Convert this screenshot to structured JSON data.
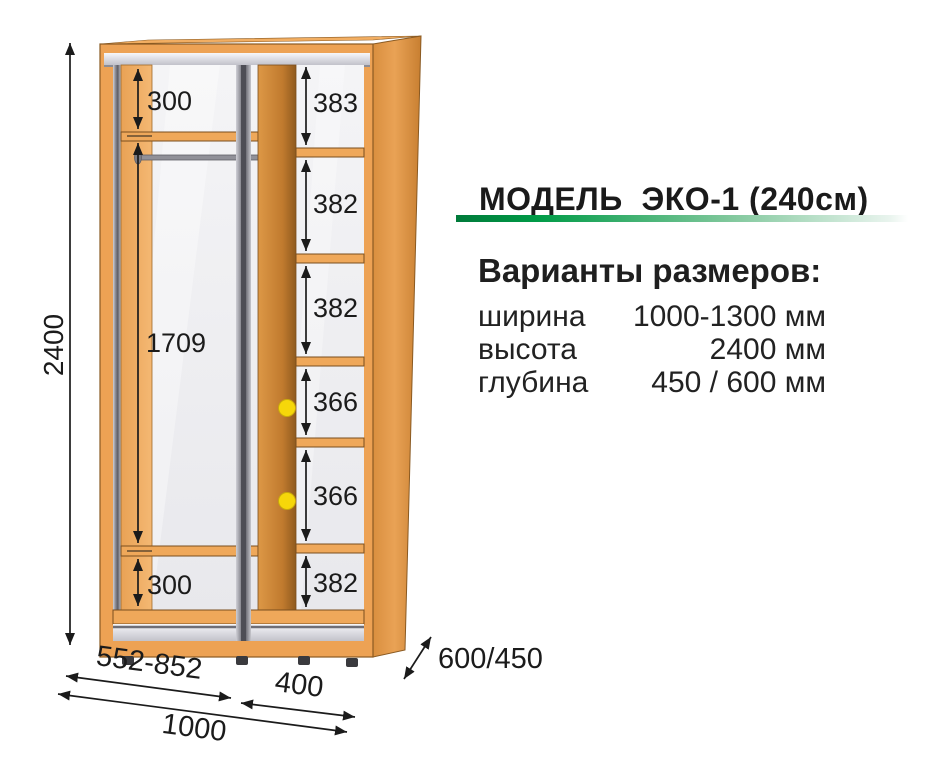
{
  "model": {
    "title": "МОДЕЛЬ  ЭКО-1 (240см)",
    "accent_green": "#009245"
  },
  "specs": {
    "heading": "Варианты размеров:",
    "rows": [
      {
        "label": "ширина",
        "value": "1000-1300 мм"
      },
      {
        "label": "высота",
        "value": "2400 мм"
      },
      {
        "label": "глубина",
        "value": "450 / 600 мм"
      }
    ]
  },
  "dims": {
    "total_height": "2400",
    "left_gaps": [
      "300",
      "1709",
      "300"
    ],
    "right_gaps": [
      "383",
      "382",
      "382",
      "366",
      "366",
      "382"
    ],
    "door_zone_width": "552-852",
    "shelf_zone_width": "400",
    "total_width": "1000",
    "depth": "600/450"
  },
  "colors": {
    "wood": "#EDA254",
    "wood_dark": "#8A5A22",
    "metal": "#9A9AA2",
    "mirror": "#F0F0F3",
    "marker_yellow": "#F6D70A",
    "dim_text": "#1B1B1B"
  }
}
